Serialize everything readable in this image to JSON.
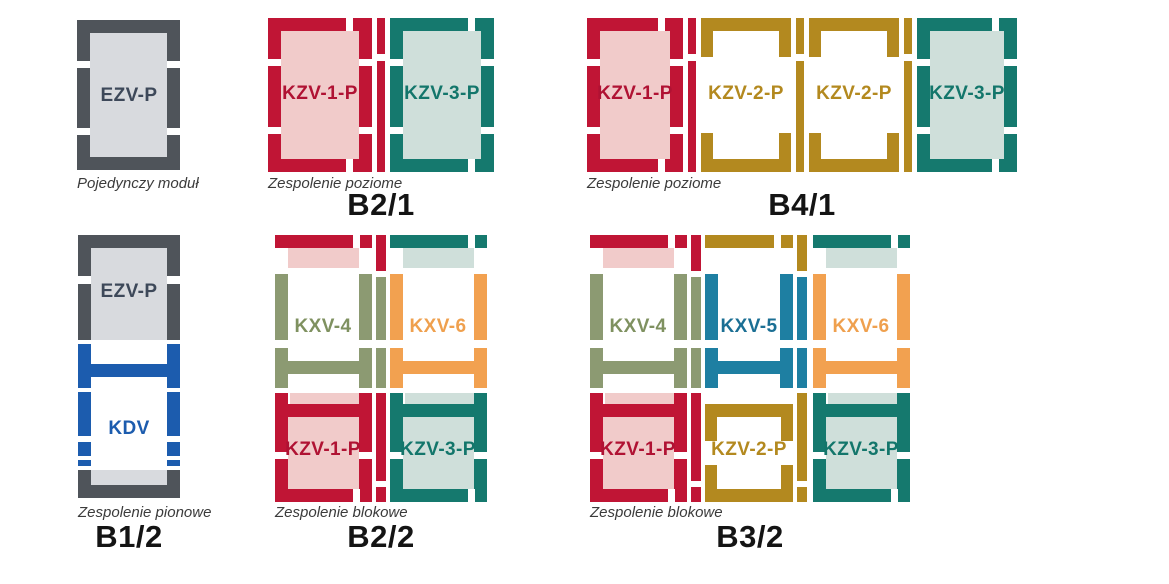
{
  "palette": {
    "red_frame": "#c01535",
    "red_fill": "#f1cbca",
    "teal_frame": "#15796e",
    "teal_fill": "#cfdfda",
    "gold_frame": "#b3891f",
    "olive_frame": "#8c9a72",
    "orange_frame": "#f2a150",
    "steel_blue_frame": "#1e7fa2",
    "blue_frame": "#1c5cae",
    "gray_frame": "#4f545a",
    "gray_fill": "#d8dade",
    "caption_text": "#3b3b3b",
    "title_text": "#141414"
  },
  "panels": [
    {
      "id": "single-module",
      "caption": "Pojedynczy moduł",
      "modules": [
        {
          "label": "EZV-P",
          "color": "#4f545a"
        }
      ]
    },
    {
      "id": "b2-1",
      "title": "B2/1",
      "caption": "Zespolenie poziome",
      "modules": [
        {
          "label": "KZV-1-P",
          "color": "#c01535"
        },
        {
          "label": "KZV-3-P",
          "color": "#15796e"
        }
      ]
    },
    {
      "id": "b4-1",
      "title": "B4/1",
      "caption": "Zespolenie poziome",
      "modules": [
        {
          "label": "KZV-1-P",
          "color": "#c01535"
        },
        {
          "label": "KZV-2-P",
          "color": "#b3891f"
        },
        {
          "label": "KZV-2-P",
          "color": "#b3891f"
        },
        {
          "label": "KZV-3-P",
          "color": "#15796e"
        }
      ]
    },
    {
      "id": "b1-2",
      "title": "B1/2",
      "caption": "Zespolenie pionowe",
      "modules": [
        {
          "label": "EZV-P",
          "color": "#4f545a"
        },
        {
          "label": "KDV",
          "color": "#1c5cae"
        }
      ]
    },
    {
      "id": "b2-2",
      "title": "B2/2",
      "caption": "Zespolenie blokowe",
      "modules": [
        {
          "label": "KXV-4",
          "color": "#8c9a72"
        },
        {
          "label": "KXV-6",
          "color": "#f2a150"
        },
        {
          "label": "KZV-1-P",
          "color": "#c01535"
        },
        {
          "label": "KZV-3-P",
          "color": "#15796e"
        }
      ]
    },
    {
      "id": "b3-2",
      "title": "B3/2",
      "caption": "Zespolenie blokowe",
      "modules": [
        {
          "label": "KXV-4",
          "color": "#8c9a72"
        },
        {
          "label": "KXV-5",
          "color": "#1e7fa2"
        },
        {
          "label": "KXV-6",
          "color": "#f2a150"
        },
        {
          "label": "KZV-1-P",
          "color": "#c01535"
        },
        {
          "label": "KZV-2-P",
          "color": "#b3891f"
        },
        {
          "label": "KZV-3-P",
          "color": "#15796e"
        }
      ]
    }
  ]
}
